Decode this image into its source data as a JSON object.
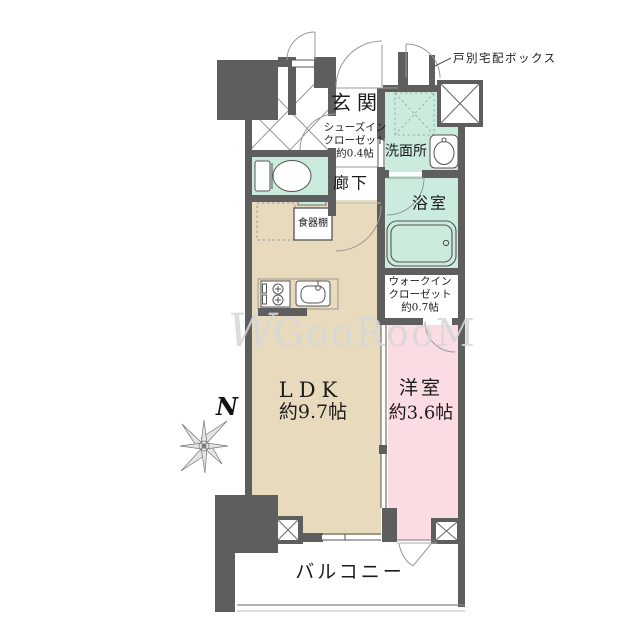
{
  "floorplan": {
    "watermark": {
      "prefix": "W",
      "text": "GooRooM"
    },
    "compass": {
      "label": "N"
    },
    "annotations": {
      "delivery_box": "戸別宅配ボックス"
    },
    "rooms": {
      "genkan": {
        "name": "玄関"
      },
      "shoes_closet": {
        "line1": "シューズイン",
        "line2": "クローゼット",
        "line3": "約0.4帖"
      },
      "hallway": {
        "name": "廊下"
      },
      "washroom": {
        "name": "洗面所"
      },
      "bathroom": {
        "name": "浴室"
      },
      "walk_in_closet": {
        "line1": "ウォークイン",
        "line2": "クローゼット",
        "line3": "約0.7帖"
      },
      "ldk": {
        "name": "LDK",
        "size": "約9.7帖"
      },
      "western_room": {
        "name": "洋室",
        "size": "約3.6帖"
      },
      "balcony": {
        "name": "バルコニー"
      },
      "cupboard": {
        "name": "食器棚"
      }
    },
    "colors": {
      "wall": "#5e5e5e",
      "wet_area": "#cbecdd",
      "ldk_floor": "#e8dabd",
      "bedroom_floor": "#fbdce3",
      "line": "#666666"
    }
  }
}
